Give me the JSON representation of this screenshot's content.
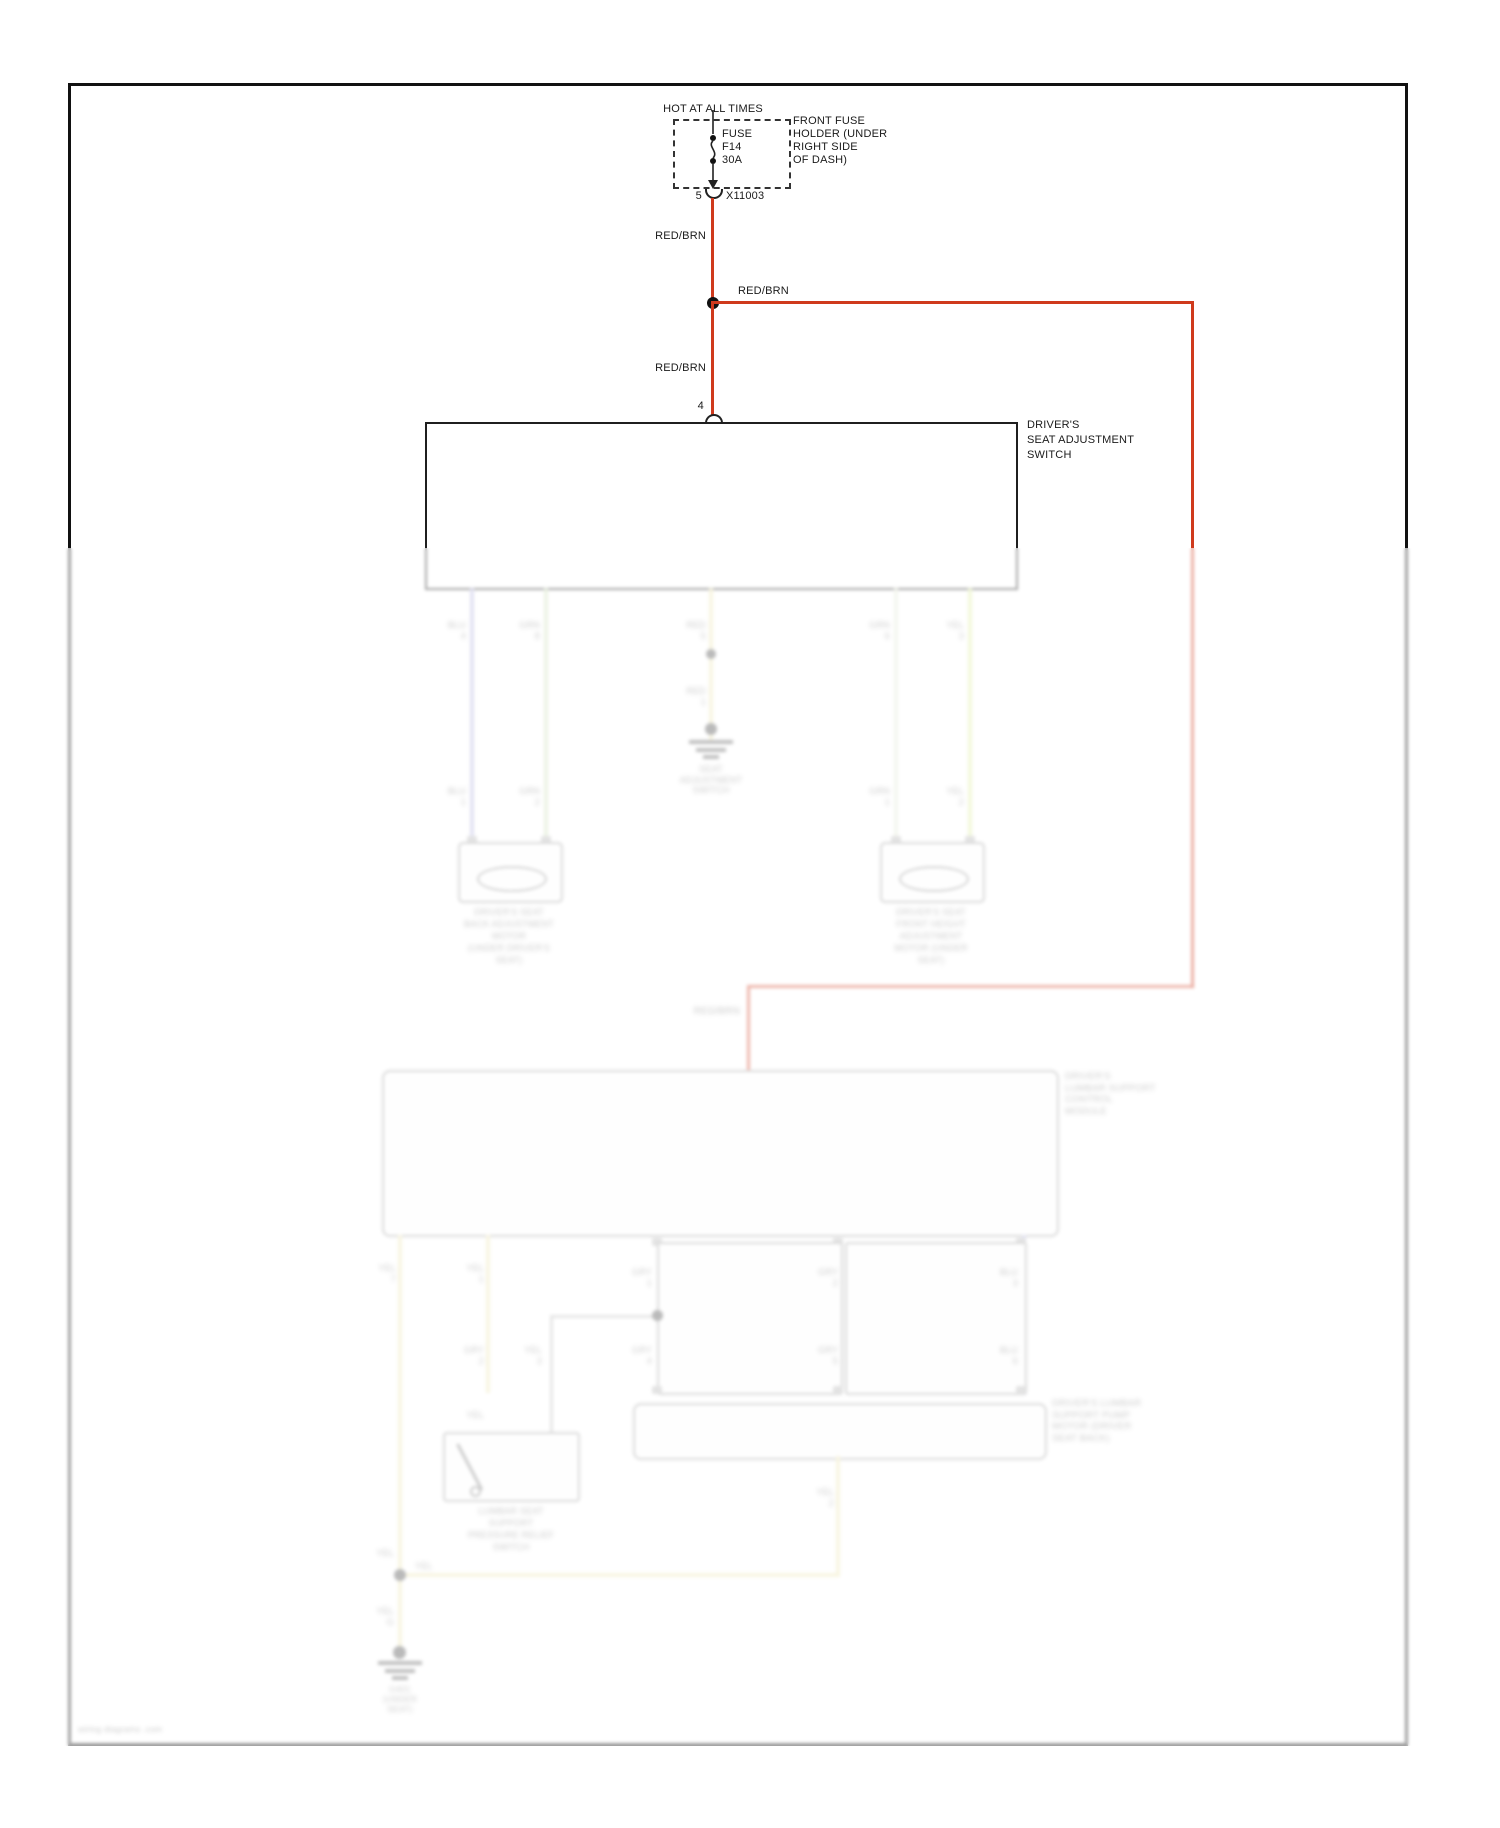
{
  "diagram": {
    "power_label": "HOT AT ALL TIMES",
    "fuse": {
      "line1": "FUSE",
      "line2": "F14",
      "line3": "30A"
    },
    "fuse_holder": [
      "FRONT FUSE",
      "HOLDER (UNDER",
      "RIGHT SIDE",
      "OF DASH)"
    ],
    "connector": {
      "pin": "5",
      "id": "X11003"
    },
    "wire_color_label": "RED/BRN",
    "switch_pin": "4",
    "switch_label": [
      "DRIVER'S",
      "SEAT ADJUSTMENT",
      "SWITCH"
    ],
    "colors": {
      "wire_red": "#cf3a1d",
      "wire_blue": "#b3b3e0",
      "wire_green": "#cde0b8",
      "wire_yellow_green": "#dcec9e",
      "wire_pale": "#e3e8d5",
      "wire_yellow": "#ece4b0",
      "wire_gray": "#bcbcbc"
    }
  },
  "faded": {
    "red_brn": "RED/BRN",
    "pins_top": [
      [
        "BLU",
        "4"
      ],
      [
        "GRN",
        "8"
      ],
      [
        "RED",
        "2"
      ],
      [
        "GRN",
        "6"
      ],
      [
        "YEL",
        "3"
      ]
    ],
    "pins_bottom": [
      [
        "BLU",
        "1"
      ],
      [
        "GRN",
        "2"
      ],
      [
        "GRN",
        "1"
      ],
      [
        "YEL",
        "2"
      ]
    ],
    "mid_pin_a": [
      "RED",
      "5"
    ],
    "mid_pin_b": [
      "RED",
      "1"
    ],
    "motor_left_label": [
      "DRIVER'S SEAT",
      "BACK ADJUSTMENT",
      "MOTOR",
      "(UNDER DRIVER'S",
      "SEAT)"
    ],
    "motor_right_label": [
      "DRIVER'S SEAT",
      "FRONT HEIGHT",
      "ADJUSTMENT",
      "MOTOR (UNDER",
      "SEAT)"
    ],
    "mid_ground_label": [
      "SEAT",
      "ADJUSTMENT",
      "SWITCH"
    ],
    "lumbar_box_label": [
      "DRIVER'S",
      "LUMBAR SUPPORT",
      "CONTROL",
      "MODULE"
    ],
    "sub_pins_top": [
      [
        "GRY",
        "1"
      ],
      [
        "GRY",
        "2"
      ],
      [
        "BLU",
        "3"
      ]
    ],
    "sub_pins_bottom": [
      [
        "GRY",
        "4"
      ],
      [
        "GRY",
        "5"
      ],
      [
        "BLU",
        "6"
      ]
    ],
    "switch_pins_top": [
      [
        "YEL",
        "1"
      ],
      [
        "GRY",
        "2"
      ]
    ],
    "switch_pin_mid": [
      "YEL",
      "3"
    ],
    "wide_box_label": [
      "DRIVER'S LUMBAR",
      "SUPPORT PUMP",
      "MOTOR (DRIVER",
      "SEAT BACK)"
    ],
    "switch_label": [
      "LUMBAR SEAT",
      "SUPPORT",
      "PRESSURE RELIEF",
      "SWITCH"
    ],
    "yellow_pin_top": [
      "YEL",
      "7"
    ],
    "yellow_mid_label": "YEL",
    "yellow_low_label": [
      "YEL",
      "G"
    ],
    "wide_out_label": [
      "YEL",
      "2"
    ],
    "junction_label": "YEL",
    "ground_label": [
      "G401",
      "(UNDER",
      "SEAT)"
    ],
    "watermark": "wiring diagrams .com"
  }
}
